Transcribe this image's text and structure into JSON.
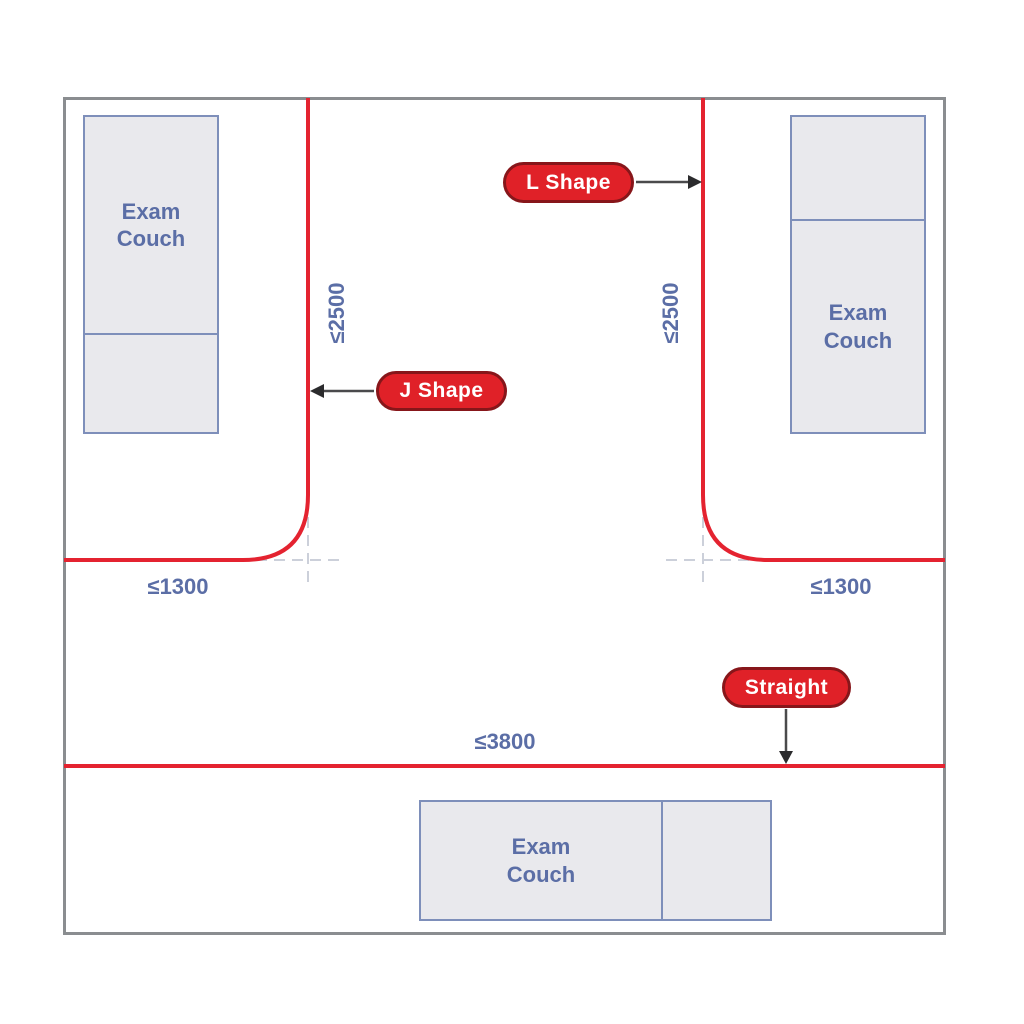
{
  "diagram": {
    "type": "curtain-track-room-layout",
    "room": {
      "couches": {
        "top_left": {
          "label": "Exam Couch"
        },
        "top_right": {
          "label": "Exam Couch"
        },
        "bottom": {
          "label": "Exam Couch"
        }
      },
      "tracks": {
        "j_shape": {
          "label": "J Shape",
          "vertical_dim": "≤2500",
          "horizontal_dim": "≤1300"
        },
        "l_shape": {
          "label": "L Shape",
          "vertical_dim": "≤2500",
          "horizontal_dim": "≤1300"
        },
        "straight": {
          "label": "Straight",
          "dim": "≤3800"
        }
      }
    },
    "colors": {
      "track_red": "#e42330",
      "pill_fill": "#e02128",
      "pill_border": "#87161a",
      "pill_text": "#ffffff",
      "couch_fill": "#e9e9ed",
      "couch_border": "#7e8fba",
      "dimension_text": "#5b6ea6",
      "room_wall": "#8a8d90",
      "arrow": "#4a4a4c",
      "dashed_guide": "#ccd0da"
    }
  }
}
